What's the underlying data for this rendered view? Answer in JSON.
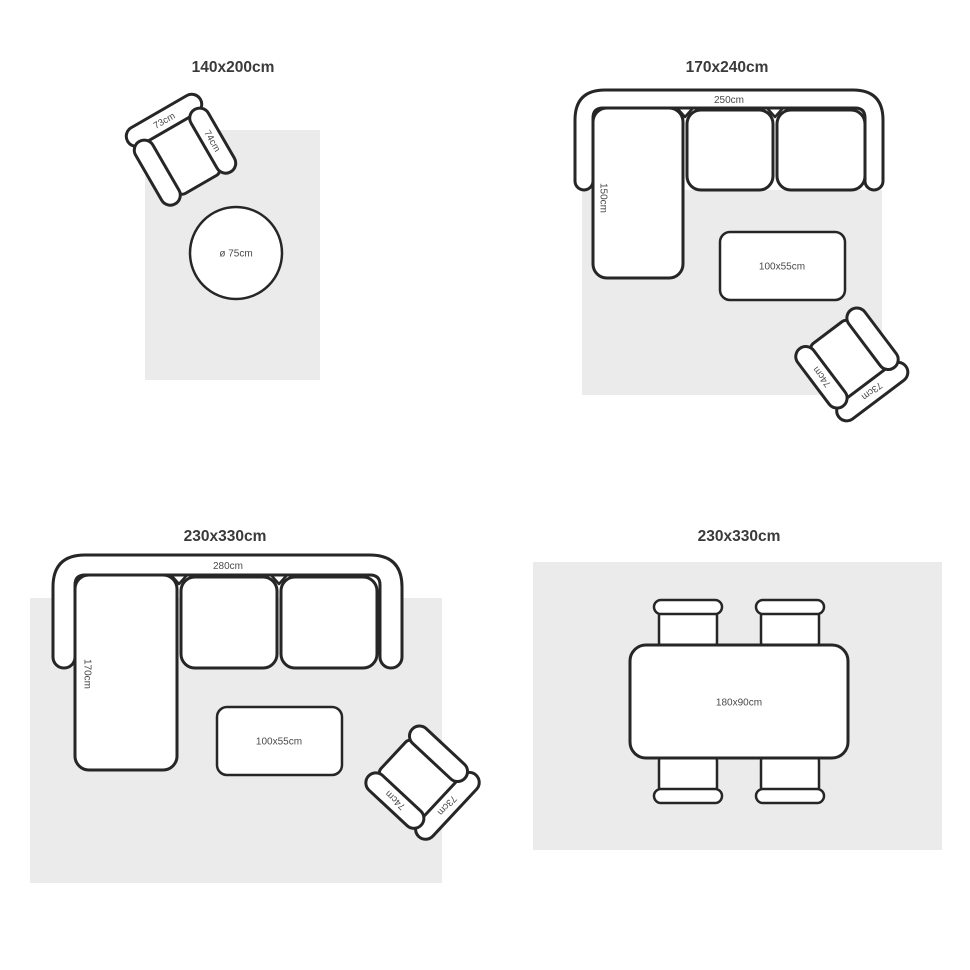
{
  "colors": {
    "background": "#ffffff",
    "rug_fill": "#ebebeb",
    "outline": "#262626",
    "title_text": "#3a3a3a",
    "dimension_text": "#4a4a4a"
  },
  "panels": {
    "rug_140x200": {
      "title": "140x200cm",
      "armchair": {
        "width": "73cm",
        "depth": "74cm"
      },
      "round_table": {
        "diameter": "ø 75cm"
      }
    },
    "rug_170x240": {
      "title": "170x240cm",
      "sofa": {
        "width": "250cm",
        "chaise_depth": "150cm"
      },
      "coffee_table": {
        "size": "100x55cm"
      },
      "armchair": {
        "width": "73cm",
        "depth": "74cm"
      }
    },
    "rug_230x330_sofa": {
      "title": "230x330cm",
      "sofa": {
        "width": "280cm",
        "chaise_depth": "170cm"
      },
      "coffee_table": {
        "size": "100x55cm"
      },
      "armchair": {
        "width": "73cm",
        "depth": "74cm"
      }
    },
    "rug_230x330_dining": {
      "title": "230x330cm",
      "dining_table": {
        "size": "180x90cm"
      }
    }
  }
}
